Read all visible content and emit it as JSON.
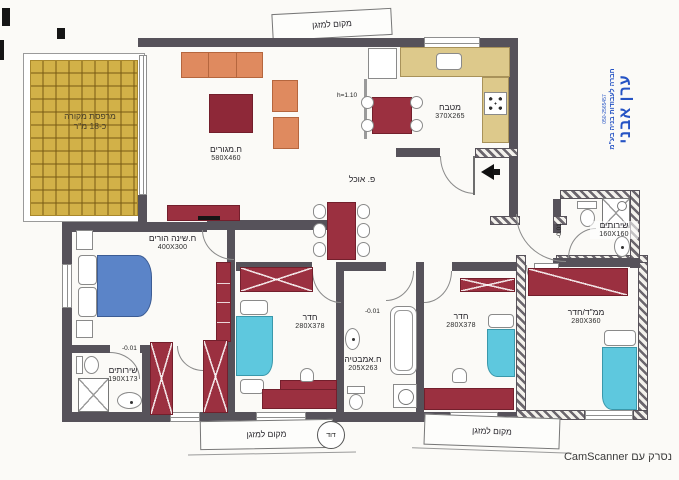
{
  "footer": {
    "scanned_with": "נסרק עם CamScanner"
  },
  "stamp": {
    "name": "ערן אבני",
    "subtitle": "חברה לעבודות בניה בע\"מ",
    "phone": "050-2565457",
    "color": "#2553c4"
  },
  "rooms": {
    "balcony": {
      "name": "מרפסת מקורה",
      "size": "כ-18 מ\"ר"
    },
    "living": {
      "name": "ח.מגורים",
      "size": "580X460"
    },
    "kitchen": {
      "name": "מטבח",
      "size": "370X265"
    },
    "parents": {
      "name": "ח.שינה הורים",
      "size": "400X300"
    },
    "wc_left": {
      "name": "שירותים",
      "size": "190X173"
    },
    "bedroom1": {
      "name": "חדר",
      "size": "280X378"
    },
    "bath": {
      "name": "ח.אמבטיה",
      "size": "205X263"
    },
    "bedroom2": {
      "name": "חדר",
      "size": "280X378"
    },
    "mamad": {
      "name": "ממ\"ד/חדר",
      "size": "280X360"
    },
    "wc_right": {
      "name": "שירותים",
      "size": "160X160"
    }
  },
  "annotations": {
    "ac_top": "מקום למזגן",
    "ac_bottom_left": "מקום למזגן",
    "ac_bottom_right": "מקום למזגן",
    "boiler": "דוד",
    "counter_height": "h=1.10",
    "dining_corner": "פ. אוכל",
    "level_entry": "+0.82",
    "level_wc_left": "-0.01",
    "level_bath": "-0.01",
    "level_wc_right": "-0.01"
  },
  "colors": {
    "wall": "#56525a",
    "furniture_maroon": "#9b3040",
    "sofa_salmon": "#df8a5f",
    "parents_bed_blue": "#5b84c8",
    "kids_bed_cyan": "#5ec8de",
    "kitchen_counter_tan": "#ddc98b",
    "balcony_tile_gold": "#d2b148",
    "stamp_blue": "#2553c4"
  }
}
